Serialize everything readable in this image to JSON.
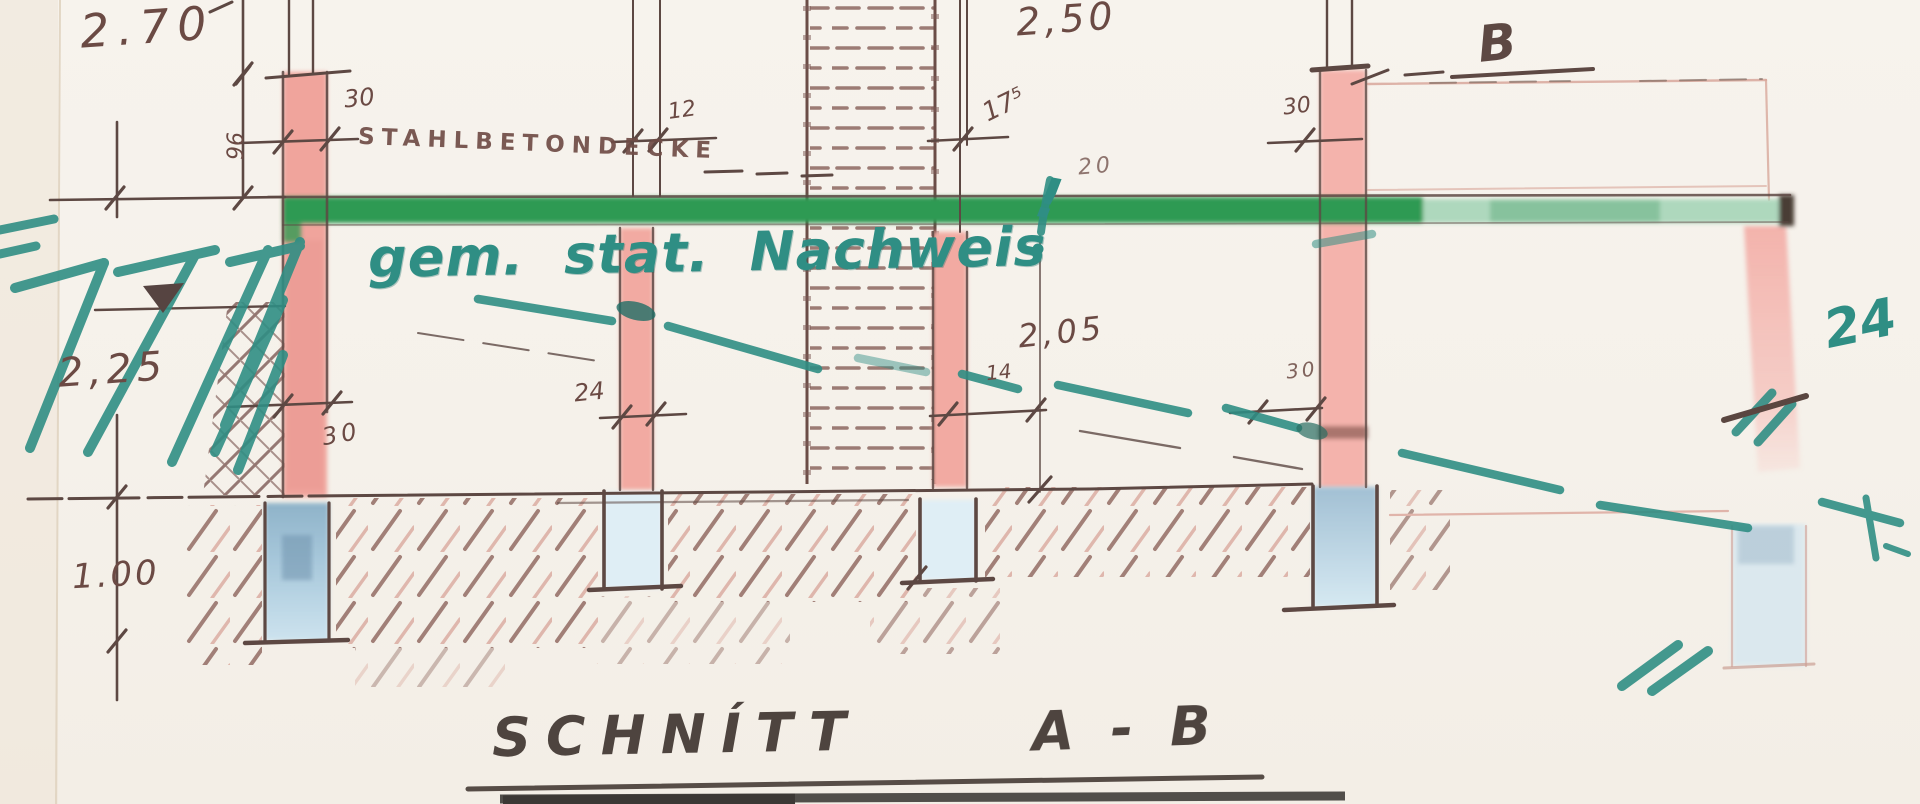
{
  "drawing": {
    "title_left": "SCHNÍTT",
    "title_right": "A - B",
    "slab_label": "STAHLBETONDECKE",
    "slab_thickness": "20",
    "annotation_text": "gem. stat. Nachweis",
    "annotation_mark": "!",
    "beam_label": "B",
    "dim_room_upper_left": "2.70",
    "dim_room_upper_right": "2,50",
    "dim_room_lower_left": "2,25",
    "dim_room_lower_right": "2,05",
    "dim_foundation_depth": "1.00",
    "dim_wall_upper_left": "30",
    "dim_wall_upper_mid": "12",
    "dim_chimney_wall": "17⁵",
    "dim_wall_upper_right": "30",
    "dim_wall_height": "96",
    "dim_col1_lower": "30",
    "dim_col2_lower": "24",
    "dim_col3_lower": "14",
    "dim_col4_lower": "30",
    "dim_col5_marked": "24"
  },
  "colors": {
    "paper": "#f5f1ea",
    "ink_line": "#6b4a44",
    "column_pink": "#f0a49c",
    "slab_green": "#2f9a52",
    "foundation_blue": "#a9c6d9",
    "revision_teal": "#2f8e84",
    "title_ink": "#4e443f"
  }
}
